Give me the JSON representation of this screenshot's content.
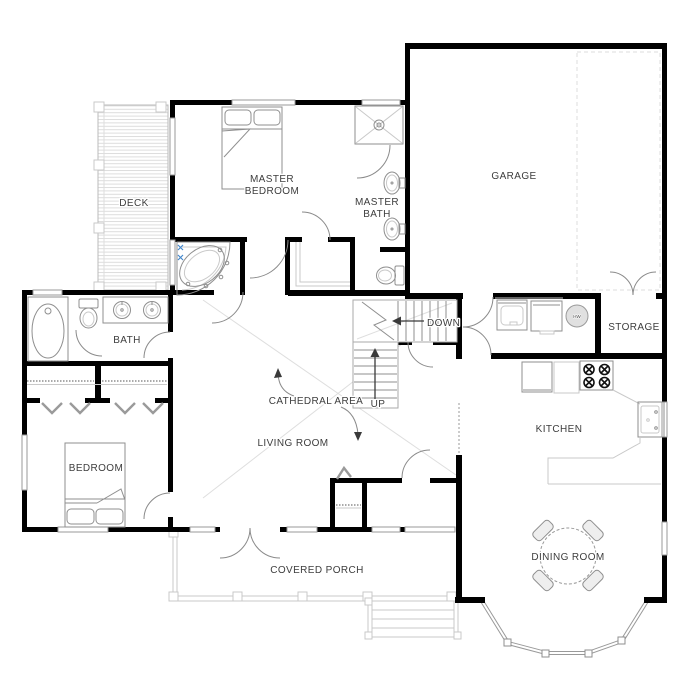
{
  "colors": {
    "wall": "#000000",
    "thin": "#8f8f8f",
    "light": "#c9c9c9",
    "label": "#3d3d3d",
    "accent": "#4488cc",
    "hw_fill": "#e0e0e0"
  },
  "rooms": {
    "deck": {
      "label": "DECK"
    },
    "master_bedroom": {
      "line1": "MASTER",
      "line2": "BEDROOM"
    },
    "master_bath": {
      "line1": "MASTER",
      "line2": "BATH"
    },
    "garage": {
      "label": "GARAGE"
    },
    "bath": {
      "label": "BATH"
    },
    "storage": {
      "label": "STORAGE"
    },
    "cathedral_area": {
      "label": "CATHEDRAL AREA"
    },
    "living_room": {
      "label": "LIVING ROOM"
    },
    "kitchen": {
      "label": "KITCHEN"
    },
    "bedroom": {
      "label": "BEDROOM"
    },
    "covered_porch": {
      "label": "COVERED PORCH"
    },
    "dining_room": {
      "label": "DINING ROOM"
    }
  },
  "stairs": {
    "down": "DOWN",
    "up": "UP"
  },
  "equipment": {
    "water_heater": "HW"
  }
}
